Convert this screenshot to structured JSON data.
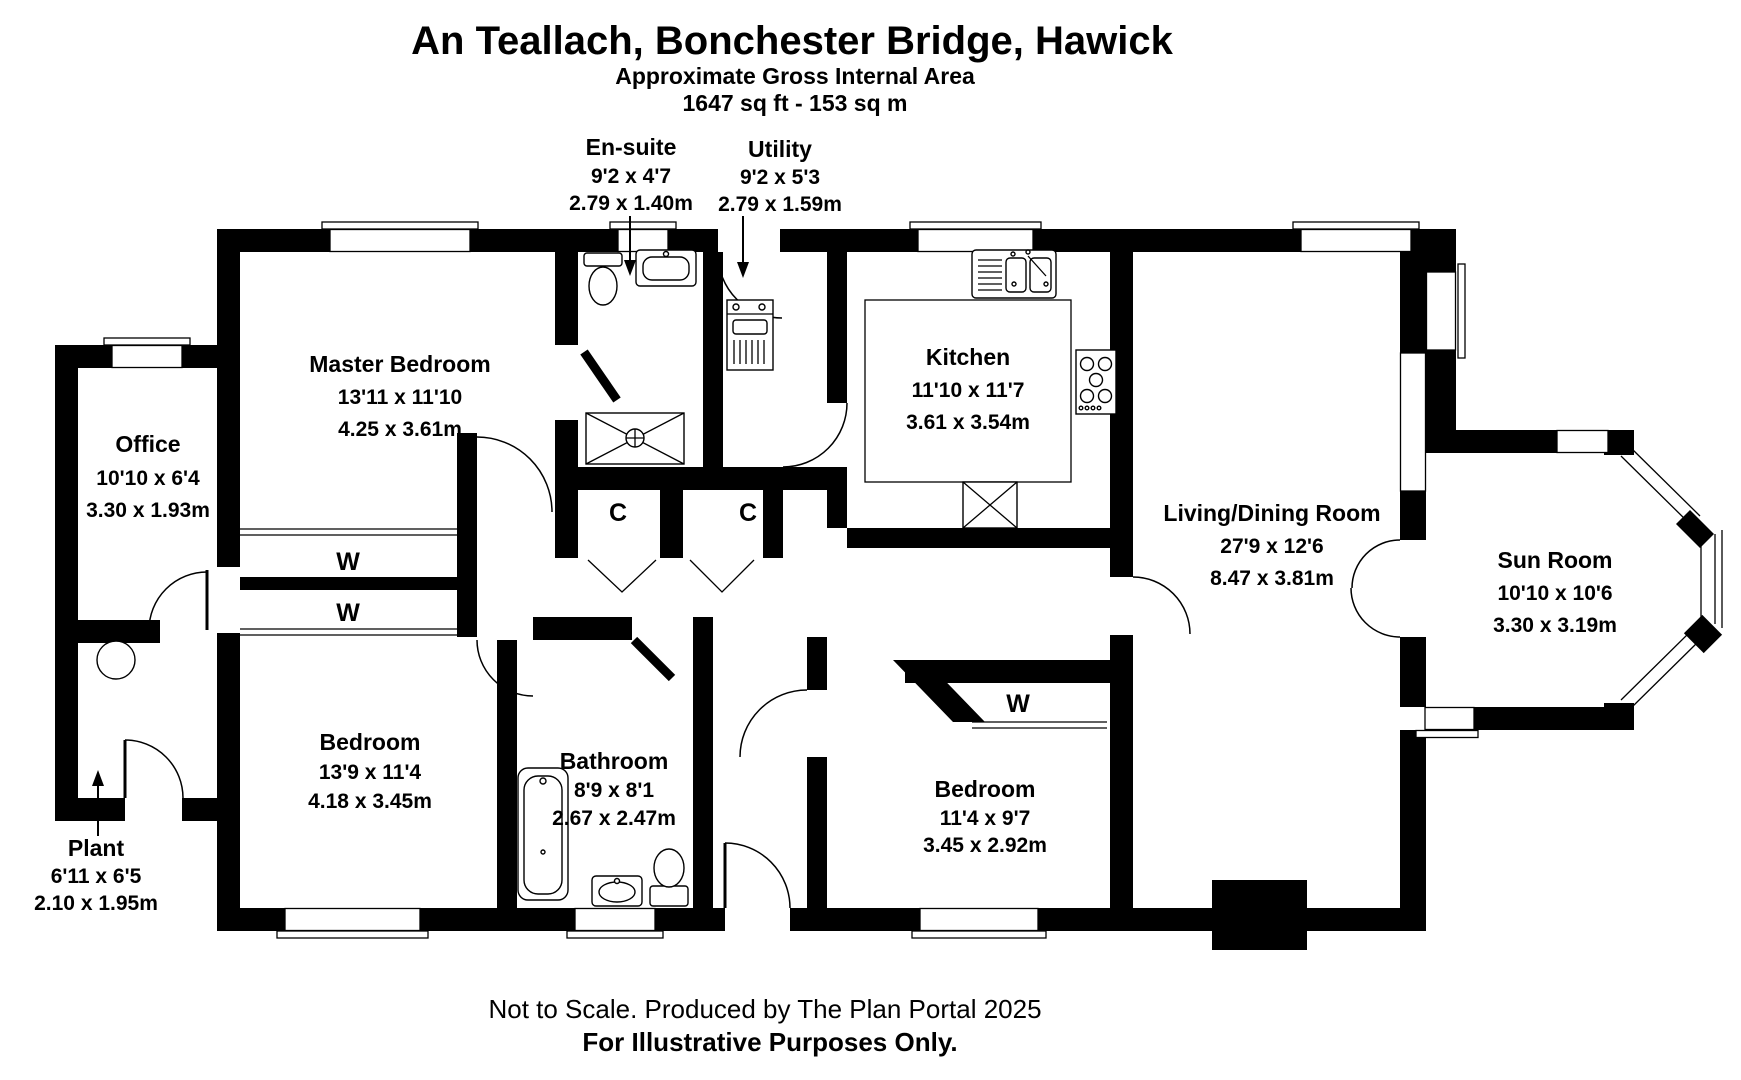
{
  "header": {
    "title": "An Teallach, Bonchester Bridge, Hawick",
    "subtitle1": "Approximate Gross Internal Area",
    "subtitle2": "1647 sq ft - 153 sq m"
  },
  "rooms": [
    {
      "id": "ensuite",
      "name": "En-suite",
      "imperial": "9'2 x 4'7",
      "metric": "2.79 x 1.40m"
    },
    {
      "id": "utility",
      "name": "Utility",
      "imperial": "9'2 x 5'3",
      "metric": "2.79 x 1.59m"
    },
    {
      "id": "master",
      "name": "Master Bedroom",
      "imperial": "13'11 x 11'10",
      "metric": "4.25 x 3.61m"
    },
    {
      "id": "office",
      "name": "Office",
      "imperial": "10'10 x 6'4",
      "metric": "3.30 x 1.93m"
    },
    {
      "id": "kitchen",
      "name": "Kitchen",
      "imperial": "11'10 x 11'7",
      "metric": "3.61 x 3.54m"
    },
    {
      "id": "living",
      "name": "Living/Dining Room",
      "imperial": "27'9 x 12'6",
      "metric": "8.47 x 3.81m"
    },
    {
      "id": "sunroom",
      "name": "Sun Room",
      "imperial": "10'10 x 10'6",
      "metric": "3.30 x 3.19m"
    },
    {
      "id": "bedroom-left",
      "name": "Bedroom",
      "imperial": "13'9 x 11'4",
      "metric": "4.18 x 3.45m"
    },
    {
      "id": "bathroom",
      "name": "Bathroom",
      "imperial": "8'9 x 8'1",
      "metric": "2.67 x 2.47m"
    },
    {
      "id": "bedroom-right",
      "name": "Bedroom",
      "imperial": "11'4 x 9'7",
      "metric": "3.45 x 2.92m"
    },
    {
      "id": "plant",
      "name": "Plant",
      "imperial": "6'11 x 6'5",
      "metric": "2.10 x 1.95m"
    }
  ],
  "closets": {
    "wardrobe": "W",
    "cupboard": "C"
  },
  "footer": {
    "line1": "Not to Scale. Produced by The Plan Portal 2025",
    "line2": "For Illustrative Purposes Only."
  },
  "colors": {
    "wall": "#000000",
    "background": "#ffffff",
    "text": "#000000"
  }
}
